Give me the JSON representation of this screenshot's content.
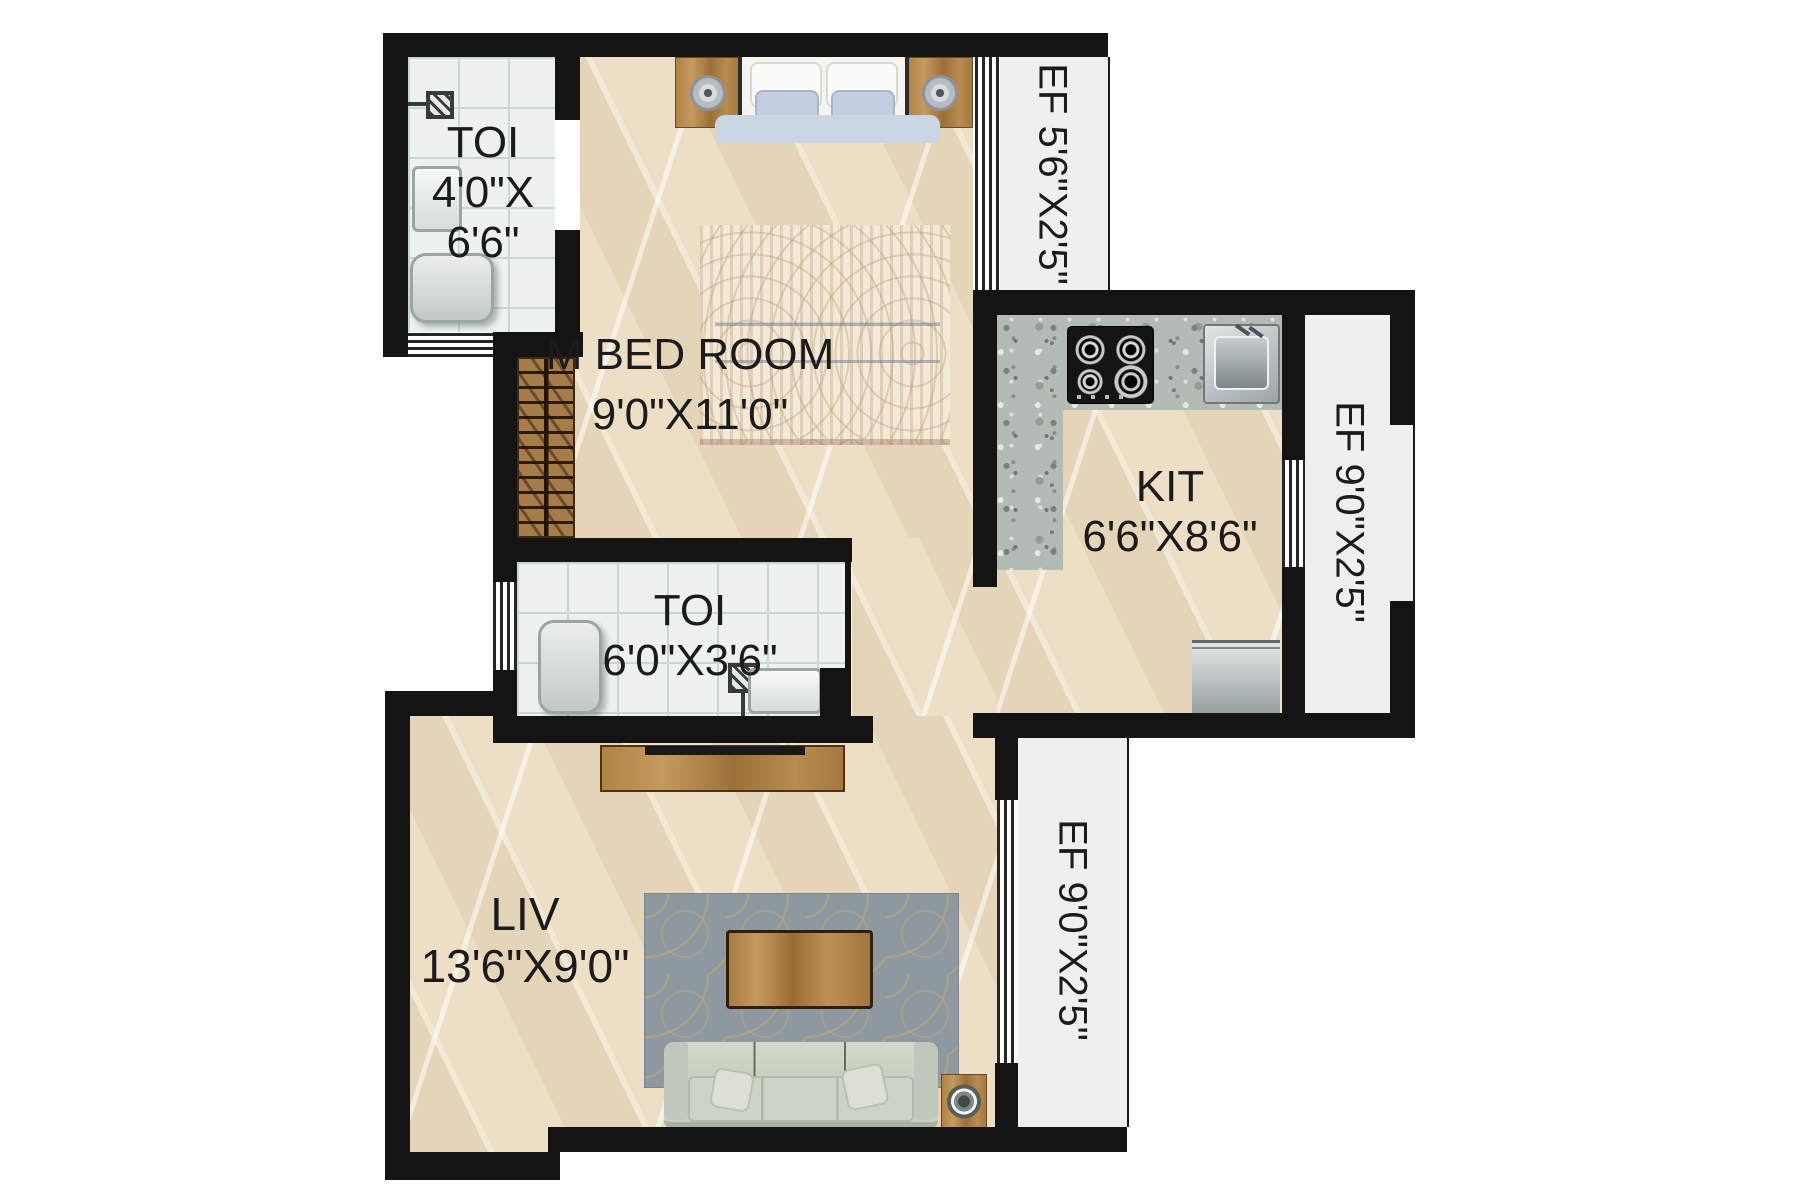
{
  "rooms": {
    "toilet_top": {
      "label": "TOI",
      "dim_line1": "4'0\"X",
      "dim_line2": "6'6\""
    },
    "master_bedroom": {
      "label": "M BED ROOM",
      "dim": "9'0\"X11'0\""
    },
    "kitchen": {
      "label": "KIT",
      "dim": "6'6\"X8'6\""
    },
    "toilet_mid": {
      "label": "TOI",
      "dim": "6'0\"X3'6\""
    },
    "living": {
      "label": "LIV",
      "dim": "13'6\"X9'0\""
    }
  },
  "ef": {
    "top": "EF 5'6\"X2'5\"",
    "right": "EF 9'0\"X2'5\"",
    "bottom": "EF 9'0\"X2'5\""
  },
  "fixtures": [
    "double-bed",
    "bedside-table-left",
    "bedside-table-right",
    "bedroom-rug",
    "wardrobe",
    "shower-toilet-top",
    "wash-basin-toilet-top",
    "wc-toilet-top",
    "kitchen-counter",
    "gas-stove",
    "kitchen-sink",
    "washing-machine",
    "wc-toilet-mid",
    "shower-toilet-mid",
    "wash-basin-toilet-mid",
    "tv-console",
    "living-rug",
    "coffee-table",
    "sofa",
    "side-table-with-plant"
  ],
  "colors": {
    "wall": "#141414",
    "floor": "#ecdfc5",
    "tile": "#edf2f0",
    "tile_line": "#c9d6d2",
    "ef": "#eef0ef",
    "granite": "#b4bbb4",
    "wood": "#a87c49",
    "sofa": "#c6cfc1",
    "bed": "#b6c3d6",
    "rug_living": "#8d98a1",
    "rug_gold": "#c5aa6a",
    "window_line": "#262626",
    "label": "#1b1b1b"
  }
}
